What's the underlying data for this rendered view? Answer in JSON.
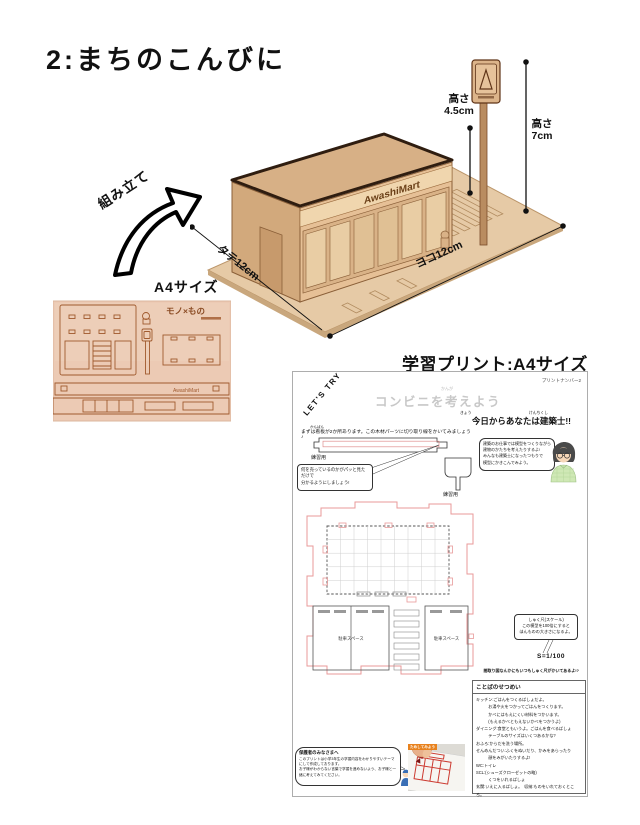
{
  "page": {
    "title": "2:まちのこんびに"
  },
  "colors": {
    "wood": "#e3c096",
    "wood_dark": "#6b4018",
    "plan_pink": "#e89a9a",
    "tag_orange": "#e8821e",
    "title_gray": "#c8c8c8"
  },
  "model": {
    "brand": "AwashiMart",
    "assemble_label": "組み立て",
    "a4_label": "A4サイズ",
    "dims": {
      "height_small_label": "高さ",
      "height_small_value": "4.5cm",
      "height_big_label": "高さ",
      "height_big_value": "7cm",
      "depth": "タテ12cm",
      "width": "ヨコ12cm"
    }
  },
  "sheet": {
    "logo": "モノ×もの",
    "brand": "AwashiMart"
  },
  "worksheet": {
    "heading": "学習プリント:A4サイズ",
    "print_number": "プリントナンバー2",
    "lets_try": "LET'S TRY",
    "title": "コンビニを考えよう",
    "title_ruby": "かんが",
    "subtitle": "今日からあなたは建築士!!",
    "ruby_kyou": "きょう",
    "ruby_kenchikushi": "けんちくし",
    "instruction": "まずは看板が2か所あります。この木材パーツに切り取り線をかいてみましょう♪",
    "ruby_kanban": "かんばん",
    "practice_label_1": "練習用",
    "practice_label_2": "練習用",
    "bubble_left": "何を売っているのかがパッと見ただけで\n分かるようにしましょう!",
    "bubble_right": "建築のお仕事では模型をつくりながら\n建物のかたちを考えたりするよ!\nみんなも建築士になったつもりで\n模型にかきこんでみよう。",
    "plan": {
      "parking": "駐車スペース"
    },
    "scale_bubble": "しゅく尺(スケール)\nこの模型を100倍にすると\nほんものの大きさになるよ。",
    "scale_value": "S=1/100",
    "scale_note": "間取り図なんかにもいつもしゅく尺がかいてあるよ!?",
    "glossary_title": "ことばのせつめい",
    "glossary_text": "キッチン:ごはんをつくるばしょだよ。\n　　　お湯や火をつかってごはんをつくります。\n　　　かべにはもえにくい材料をつかいます。\n　　　(もえるかべともえないかべをつかうよ)\nダイニング:食堂ともいうよ。ごはんを食べるばしょ\n　　　テーブルのサイズはいくつあるかな?\nおふろ:からだを洗う場所。\nせんめんだつい:ふくをぬいだり、かみをあらったり\n　　　顔をみがいたりするよ!\nWC:トイレ\nSCL:(シューズクローゼットの略)\n　　　くつをいれるばしょ\n玄関:いえに入るばしょ。　収納:ものをいれておくところ。",
    "parents_title": "保護者のみなさまへ",
    "parents_text": "このプリントは小学3年生の学習内容をわかりやすいテーマにして作成しております。\nお子様がわからない言葉で学習を進めないよう、お子様と一緒に考えてみてください。",
    "photo_tag": "ためしてみよう"
  }
}
